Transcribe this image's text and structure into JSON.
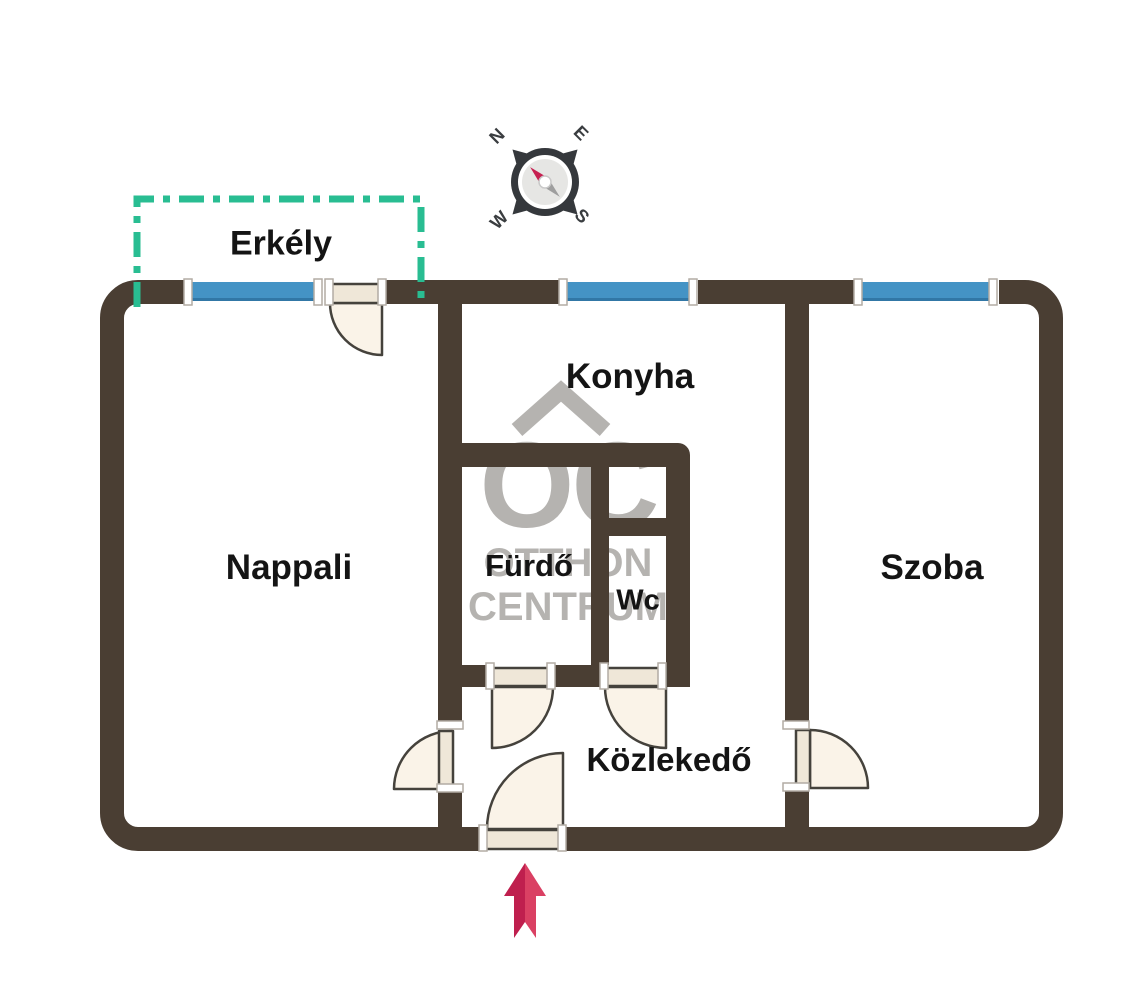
{
  "plan": {
    "type": "apartment floor plan",
    "rooms": [
      {
        "id": "erkely",
        "label": "Erkély"
      },
      {
        "id": "nappali",
        "label": "Nappali"
      },
      {
        "id": "konyha",
        "label": "Konyha"
      },
      {
        "id": "furdo",
        "label": "Fürdő"
      },
      {
        "id": "wc",
        "label": "Wc"
      },
      {
        "id": "szoba",
        "label": "Szoba"
      },
      {
        "id": "kozlekedo",
        "label": "Közlekedő"
      }
    ]
  },
  "compass": {
    "north": "N",
    "east": "E",
    "west": "W",
    "south": "S"
  },
  "watermark": {
    "logo": "OC",
    "name_line1": "OTTHON",
    "name_line2": "CENTRUM"
  },
  "colors": {
    "wall": "#4a3e33",
    "window": "#4493c5",
    "window_edge": "#3177a6",
    "balcony_outline": "#29bd92",
    "door_fill": "#faf3e8",
    "door_leaf": "#efe7d8",
    "door_stroke": "#45423c",
    "watermark": "#b5b3b0",
    "compass_needle_red": "#c62051",
    "compass_needle_gray": "#9e9e9e",
    "compass_ring": "#35383c",
    "entry_arrow_dark": "#bf1f4e",
    "entry_arrow_light": "#da4063"
  }
}
